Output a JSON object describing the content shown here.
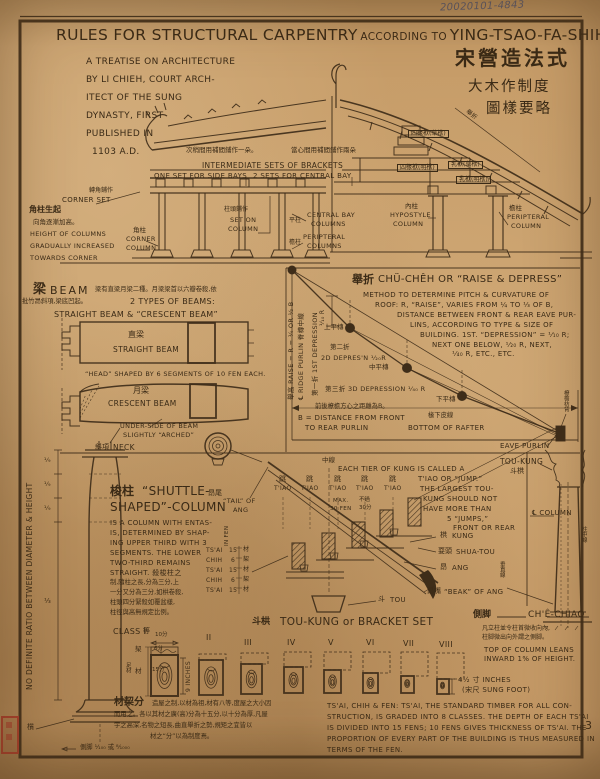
{
  "doc": {
    "pencil_note": "20020101-4843",
    "page_number": "3",
    "title": {
      "main": "RULES FOR STRUCTURAL CARPENTRY",
      "mid": "ACCORDING TO",
      "name": "YING-TSAO-FA-SHIH."
    },
    "intro": [
      "A TREATISE ON ARCHITECTURE",
      "BY LI CHIEH, COURT ARCH-",
      "ITECT OF THE SUNG",
      "DYNASTY, FIRST",
      "PUBLISHED IN",
      "1103 A.D."
    ],
    "cn_title": [
      "宋營造法式",
      "大木作制度",
      "圖樣要略"
    ]
  },
  "elev": {
    "cn_side": "次稍間用補間鋪作一朵。",
    "cn_central": "當心間用補間鋪作兩朵",
    "br1": "INTERMEDIATE SETS OF BRACKETS",
    "br2": "ONE SET FOR SIDE BAYS",
    "br3": "2 SETS FOR CENTRAL BAY",
    "corner_set_cn": "轉角鋪作",
    "corner_set": "CORNER SET",
    "rise_cn1": "角柱生起",
    "rise_cn2": "向角逐漸加高。",
    "h1": "HEIGHT OF COLUMNS",
    "h2": "GRADUALLY INCREASED",
    "h3": "TOWARDS CORNER",
    "corner_col_cn": "角柱",
    "corner_col1": "CORNER",
    "corner_col2": "COLUMN",
    "seton_cn": "柱頭鋪作",
    "seton1": "SET ON",
    "seton2": "COLUMN",
    "central_cn": "平柱",
    "central1": "CENTRAL BAY",
    "central2": "COLUMNS",
    "peri_cn": "檐柱",
    "peri1": "PERIPTERAL",
    "peri2": "COLUMNS"
  },
  "sect": {
    "b4r": "四椽栿(草栿)",
    "b4e": "四椽栿(明栿)",
    "b2r": "乳栿(草栿)",
    "b2e": "乳栿(明栿)",
    "juzhe": "舉折",
    "hypo_cn": "內柱",
    "hypo1": "HYPOSTYLE",
    "hypo2": "COLUMN",
    "peri_cn": "檐柱",
    "peri1": "PERIPTERAL",
    "peri2": "COLUMN"
  },
  "beam": {
    "cn": "梁",
    "en": "BEAM",
    "d1": "梁有直梁月梁二種。月梁梁首以六瓣卷殺,依",
    "d2": "批竹昂斜項,梁底凹起。",
    "t1": "2 TYPES OF BEAMS:",
    "t2": "STRAIGHT BEAM & “CRESCENT BEAM”",
    "straight_cn": "直梁",
    "straight": "STRAIGHT BEAM",
    "head": "“HEAD” SHAPED BY 6 SEGMENTS OF 10 FEN EACH.",
    "crescent_cn": "月梁",
    "crescent": "CRESCENT BEAM",
    "u1": "UNDER-SIDE OF BEAM",
    "u2": "SLIGHTLY “ARCHED”",
    "neck_cn": "斜項",
    "neck": "NECK"
  },
  "chu": {
    "t_cn": "舉折",
    "t": "CHÜ-CHÊH OR “RAISE & DEPRESS”",
    "body": [
      "METHOD TO DETERMINE PITCH & CURVATURE OF",
      "ROOF:  R, “RAISE”, VARIES FROM ¼ TO ⅓ OF B,",
      "DISTANCE BETWEEN FRONT & REAR EAVE PUR-",
      "LINS, ACCORDING TO TYPE & SIZE OF",
      "BUILDING.   1ST. “DEPRESSION” = ¹⁄₁₀ R;",
      "NEXT ONE BELOW, ¹⁄₂₀ R, NEXT,",
      "¹⁄₄₀ R, ETC., ETC."
    ],
    "raise_v": "舉高 RAISE = R = ¼ OR ⅓ B",
    "ridge_v": "℄ RIDGE PURLIN 脊槫中線",
    "dep1_v": "第一折 1ST DEPRESSION",
    "r10": "¹⁄₁₀ R",
    "p_up": "上平槫",
    "dep2_cn": "第二折",
    "dep2": "2D DEPRES'N ¹⁄₂₀R",
    "p_mid": "中平槫",
    "dep3": "第三折  3D DEPRESSION  ¹⁄₄₀ R",
    "p_low": "下平槫",
    "b_cn": "前後橑檐方心之距離為B。",
    "b1": "B = DISTANCE FROM FRONT",
    "b2": "TO REAR PURLIN",
    "rafter_cn": "椽下皮線",
    "rafter": "BOTTOM OF RAFTER",
    "eave": "EAVE PURLIN",
    "eaveback_v": "橑檐枋背"
  },
  "col": {
    "ratio_v": "NO DEFINITE RATIO BETWEEN DIAMETER & HEIGHT",
    "f9": "¹⁄₉",
    "f3": "⅓",
    "zhi_cn": "櫍",
    "cechiao_note": "側脚 ¹⁄₁₀₀ 或 ⁸⁄₁₀₀₀"
  },
  "shuttle": {
    "cn": "梭柱",
    "t1": "“SHUTTLE-",
    "t2": "SHAPED”-COLUMN",
    "body": [
      "IS A COLUMN WITH ENTAS-",
      "IS, DETERMINED BY SHAP-",
      "ING UPPER THIRD WITH 3",
      "SEGMENTS.  THE LOWER",
      "TWO-THIRD REMAINS",
      "STRAIGHT.   殺梭柱之",
      "制,隨柱之長,分為三分,上",
      "一分又分為三分,如栱卷殺,",
      "柱頭四分緊殺如覆盆樣,",
      "柱徑與高無規定比例。"
    ]
  },
  "tk": {
    "center_cn": "中線",
    "body": [
      "EACH TIER OF KUNG IS CALLED A",
      "T'IAO OR “JUMP.”",
      "THE LARGEST TOU-",
      "KUNG SHOULD NOT",
      "HAVE MORE THAN",
      "5 “JUMPS,”",
      "FRONT OR REAR"
    ],
    "tiao_cn": "跳",
    "tiao": "T'IAO",
    "max1": "MAX.",
    "max2": "30 FEN",
    "maxcn1": "不過",
    "maxcn2": "30分",
    "tail_cn": "昂尾",
    "tail1": "“TAIL” OF",
    "tail2": "ANG",
    "kung_cn": "栱",
    "kung": "KUNG",
    "shua_cn": "耍頭",
    "shua": "SHUA-TOU",
    "ang_cn": "昂",
    "ang": "ANG",
    "beak_cn": "昂嘴",
    "beak": "“BEAK” OF ANG",
    "tou_cn": "斗",
    "tou": "TOU",
    "cap_cn": "斗栱",
    "cap": "TOU-KUNG or BRACKET SET",
    "fen_v": "IN FEN",
    "table": [
      {
        "n": "TS'AI",
        "f": "15",
        "c": "材"
      },
      {
        "n": "CHIH",
        "f": "6",
        "c": "栔"
      },
      {
        "n": "TS'AI",
        "f": "15",
        "c": "材"
      },
      {
        "n": "CHIH",
        "f": "6",
        "c": "栔"
      },
      {
        "n": "TS'AI",
        "f": "15",
        "c": "材"
      }
    ]
  },
  "rc": {
    "tk1": "TOU-KUNG",
    "tk_cn": "斗栱",
    "cl": "℄ COLUMN",
    "center_v": "柱中線",
    "plumb_v": "垂直線",
    "ce_cn": "側脚",
    "ce": "CH'Ê-CHIAO",
    "note1": "凡立柱並令柱首微收向內,",
    "note2": "柱脚微出向外謂之側脚。",
    "lean1": "TOP OF COLUMN LEANS",
    "lean2": "INWARD 1% OF HEIGHT."
  },
  "cls": {
    "c1": "CLASS I",
    "c1_cn": "等",
    "w": "10分",
    "chih_cn": "栔",
    "chih_f": "6分",
    "tsai_cn": "材",
    "tsai_f": "15分",
    "full_cn": "足材",
    "inches9": "9 INCHES",
    "numerals": [
      "II",
      "III",
      "IV",
      "V",
      "VI",
      "VII",
      "VIII"
    ],
    "dim8a": "4½ 寸 INCHES",
    "dim8b": "(宋尺 SUNG FOOT)"
  },
  "tf": {
    "h_cn": "材栔分",
    "cn": [
      "造屋之制,以材為祖,材有八等,度屋之大小因",
      "而用之。各以其材之廣(高)分為十五分,以十分為厚,凡屋",
      "宇之高深,名物之短長,曲直舉折之勢,規矩之宜皆以",
      "材之“分”以為制度焉。"
    ],
    "en": [
      "TS'AI, CHIH & FEN:  TS'AI, THE STANDARD TIMBER FOR ALL CON-",
      "STRUCTION, IS GRADED INTO 8 CLASSES.  THE DEPTH OF EACH TS'AI",
      "IS DIVIDED INTO 15 FENS; 10 FENS GIVES THICKNESS OF TS'AI. THE",
      "PROPORTION OF EVERY PART OF THE BUILDING IS THUS MEASURED IN",
      "TERMS OF THE FEN."
    ]
  }
}
